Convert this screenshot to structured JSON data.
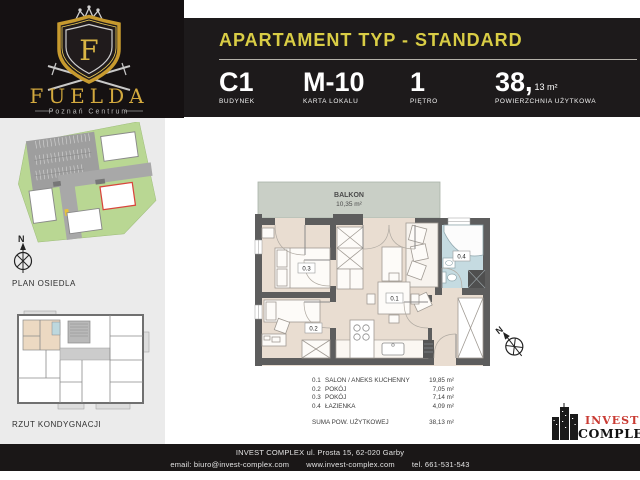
{
  "brand": {
    "name": "FUELDA",
    "subtitle": "Poznań Centrum",
    "monogram": "F"
  },
  "header": {
    "title": "APARTAMENT TYP - STANDARD",
    "stats": [
      {
        "value": "C1",
        "suffix": "",
        "label": "BUDYNEK"
      },
      {
        "value": "M-10",
        "suffix": "",
        "label": "KARTA LOKALU"
      },
      {
        "value": "1",
        "suffix": "",
        "label": "PIĘTRO"
      },
      {
        "value": "38,",
        "suffix": "13 m²",
        "label": "POWIERZCHNIA UŻYTKOWA"
      }
    ]
  },
  "sidebar": {
    "compass_letter": "N",
    "site_plan_caption": "PLAN OSIEDLA",
    "floor_plan_caption": "RZUT KONDYGNACJI"
  },
  "plan": {
    "balcony_label": "BALKON",
    "balcony_area": "10,35 m²",
    "compass_letter": "N",
    "room_labels": {
      "r1": "0.1",
      "r2": "0.2",
      "r3": "0.3",
      "r4": "0.4"
    }
  },
  "legend": {
    "rows": [
      {
        "no": "0.1",
        "name": "SALON / ANEKS KUCHENNY",
        "area": "19,85 m²"
      },
      {
        "no": "0.2",
        "name": "POKÓJ",
        "area": "7,05 m²"
      },
      {
        "no": "0.3",
        "name": "POKÓJ",
        "area": "7,14 m²"
      },
      {
        "no": "0.4",
        "name": "ŁAZIENKA",
        "area": "4,09 m²"
      }
    ],
    "total_label": "SUMA POW. UŻYTKOWEJ",
    "total_area": "38,13 m²"
  },
  "partner": {
    "name_top": "INVEST",
    "name_bottom": "COMPLEX"
  },
  "footer": {
    "address": "INVEST COMPLEX ul. Prosta 15, 62-020 Garby",
    "email": "email: biuro@invest-complex.com",
    "website": "www.invest-complex.com",
    "phone": "tel. 661-531-543"
  },
  "colors": {
    "accent_yellow": "#d9cd45",
    "brand_gold": "#d3a93e",
    "highlight_red": "#d9453c",
    "bathroom_blue": "#c5dbe1",
    "floor_beige": "#e9ddd1",
    "balcony_gray": "#c9cfc6",
    "wall_gray": "#5d5d5d",
    "partner_red": "#c93a32"
  }
}
